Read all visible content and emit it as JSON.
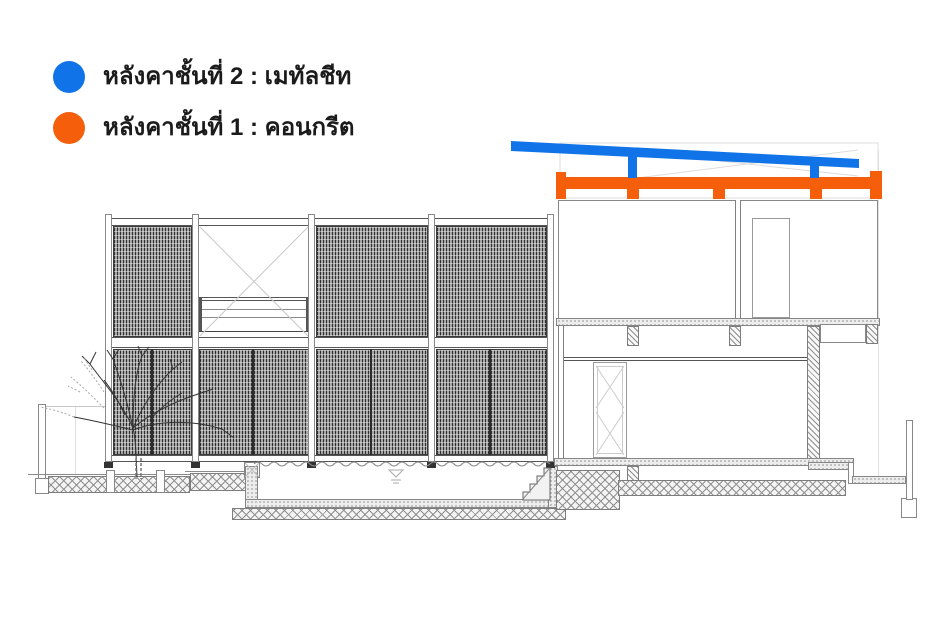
{
  "page": {
    "background_color": "#ffffff"
  },
  "colors": {
    "roof2_blue": "#1173E8",
    "roof1_orange": "#F55E0B",
    "line_dark": "#444444",
    "line_light": "#999999"
  },
  "legend": {
    "items": [
      {
        "id": "roof-level-2",
        "color": "#1173E8",
        "label": "หลังคาชั้นที่ 2 : เมทัลชีท"
      },
      {
        "id": "roof-level-1",
        "color": "#F55E0B",
        "label": "หลังคาชั้นที่ 1 : คอนกรีต"
      }
    ]
  }
}
